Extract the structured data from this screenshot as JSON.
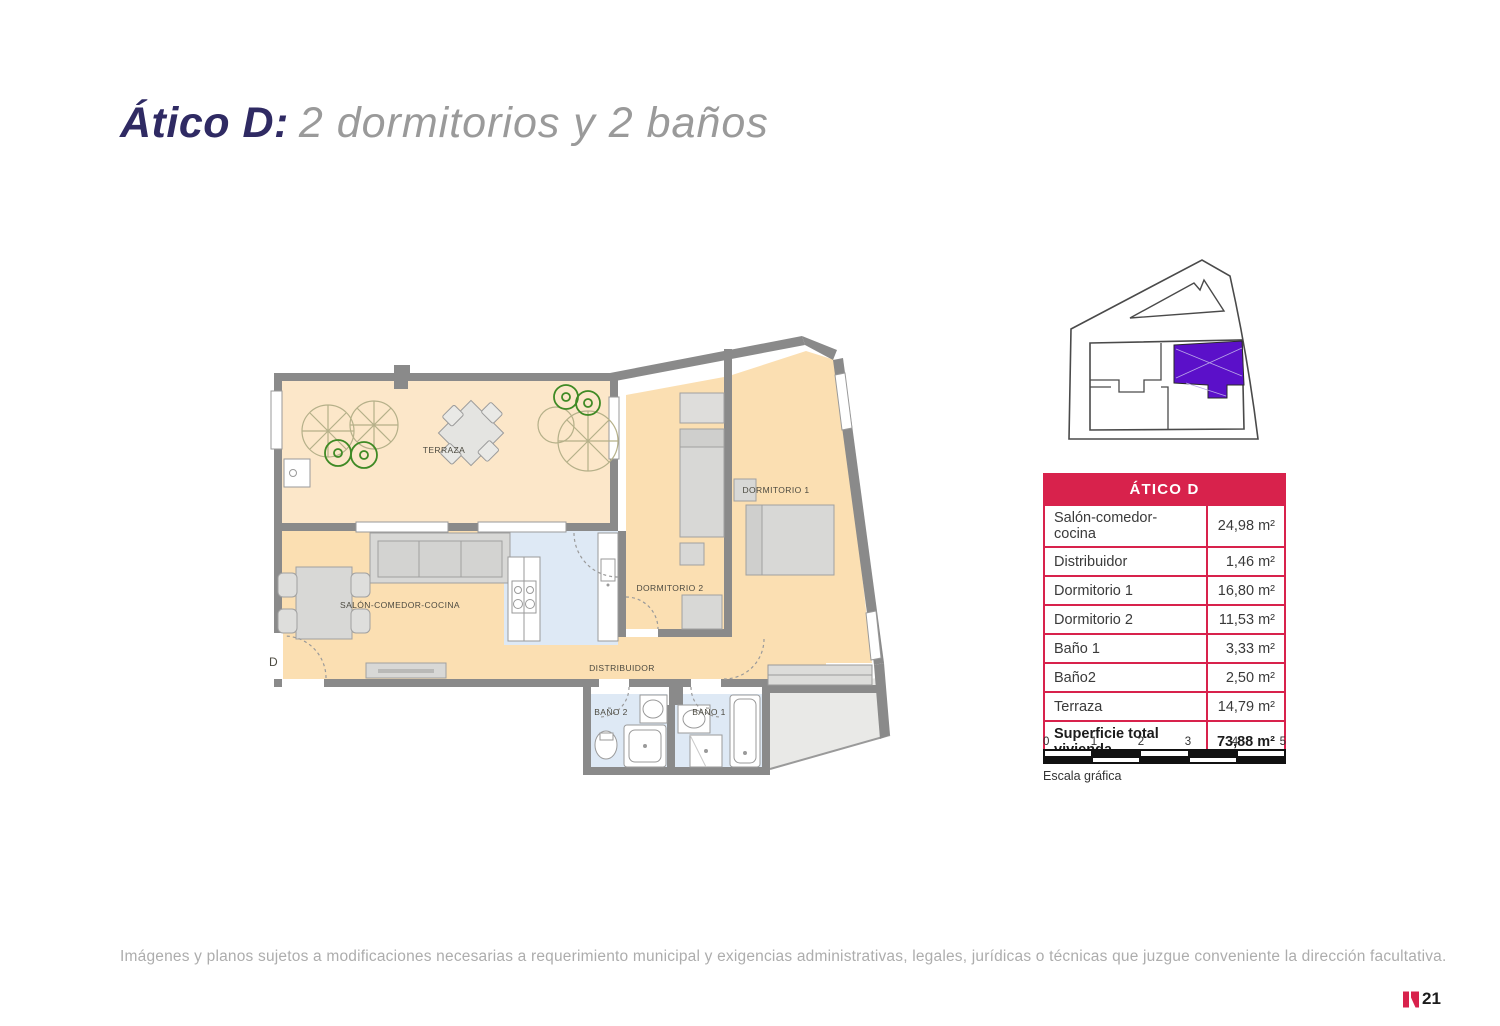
{
  "page": {
    "title_bold": "Ático D:",
    "title_light": "2 dormitorios y 2 baños",
    "footer": "Imágenes y planos sujetos a modificaciones necesarias a requerimiento municipal y exigencias administrativas, legales, jurídicas o técnicas que juzgue conveniente la dirección facultativa.",
    "page_number": "21"
  },
  "floorplan": {
    "labels": {
      "terraza": "TERRAZA",
      "salon": "SALÓN-COMEDOR-COCINA",
      "dormitorio1": "DORMITORIO 1",
      "dormitorio2": "DORMITORIO 2",
      "distribuidor": "DISTRIBUIDOR",
      "bano1": "BAÑO 1",
      "bano2": "BAÑO 2",
      "entrance": "D"
    }
  },
  "area_table": {
    "header": "ÁTICO D",
    "rows": [
      {
        "label": "Salón-comedor-cocina",
        "value": "24,98 m²"
      },
      {
        "label": "Distribuidor",
        "value": "1,46 m²"
      },
      {
        "label": "Dormitorio 1",
        "value": "16,80 m²"
      },
      {
        "label": "Dormitorio 2",
        "value": "11,53 m²"
      },
      {
        "label": "Baño 1",
        "value": "3,33 m²"
      },
      {
        "label": "Baño2",
        "value": "2,50 m²"
      },
      {
        "label": "Terraza",
        "value": "14,79 m²"
      }
    ],
    "total_label": "Superficie total vivienda",
    "total_value": "73,88 m²"
  },
  "scale_bar": {
    "ticks": [
      "0",
      "1",
      "2",
      "3",
      "4",
      "5"
    ],
    "caption": "Escala gráfica"
  },
  "colors": {
    "accent_red": "#d8224c",
    "highlight_purple": "#5b10c9",
    "title_navy": "#2f2a63",
    "wall_gray": "#8a8a8a",
    "floor_orange": "#fbdfb2",
    "floor_terrace": "#fce7c9",
    "floor_wet_blue": "#dee9f5"
  }
}
